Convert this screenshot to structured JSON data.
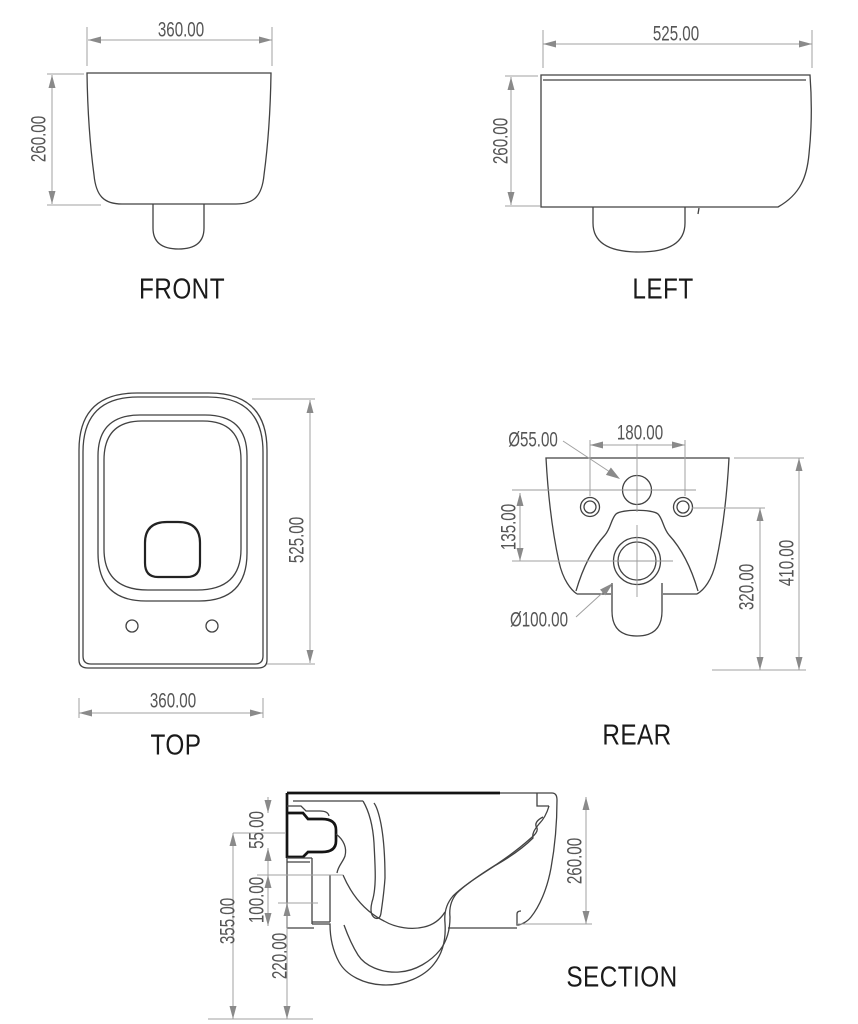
{
  "drawing": {
    "views": {
      "front": {
        "title": "FRONT",
        "width_dim": "360.00",
        "height_dim": "260.00"
      },
      "left": {
        "title": "LEFT",
        "depth_dim": "525.00",
        "height_dim": "260.00"
      },
      "top": {
        "title": "TOP",
        "depth_dim": "525.00",
        "width_dim": "360.00"
      },
      "rear": {
        "title": "REAR",
        "hole_spacing_dim": "180.00",
        "hole_diameter_dim": "Ø55.00",
        "drain_diameter_dim": "Ø100.00",
        "hole_offset_dim": "135.00",
        "drain_height_dim": "320.00",
        "overall_height_dim": "410.00"
      },
      "section": {
        "title": "SECTION",
        "rim_thickness_dim": "55.00",
        "inlet_drop_dim": "100.00",
        "outlet_height_dim": "220.00",
        "back_height_dim": "355.00",
        "height_dim": "260.00"
      }
    },
    "colors": {
      "background": "#ffffff",
      "body_line": "#424242",
      "thick_line": "#141414",
      "dimension_line": "#a0a0a0",
      "arrow_fill": "#8a8a8a",
      "dim_text": "#555555",
      "title_text": "#1a1a1a"
    }
  }
}
